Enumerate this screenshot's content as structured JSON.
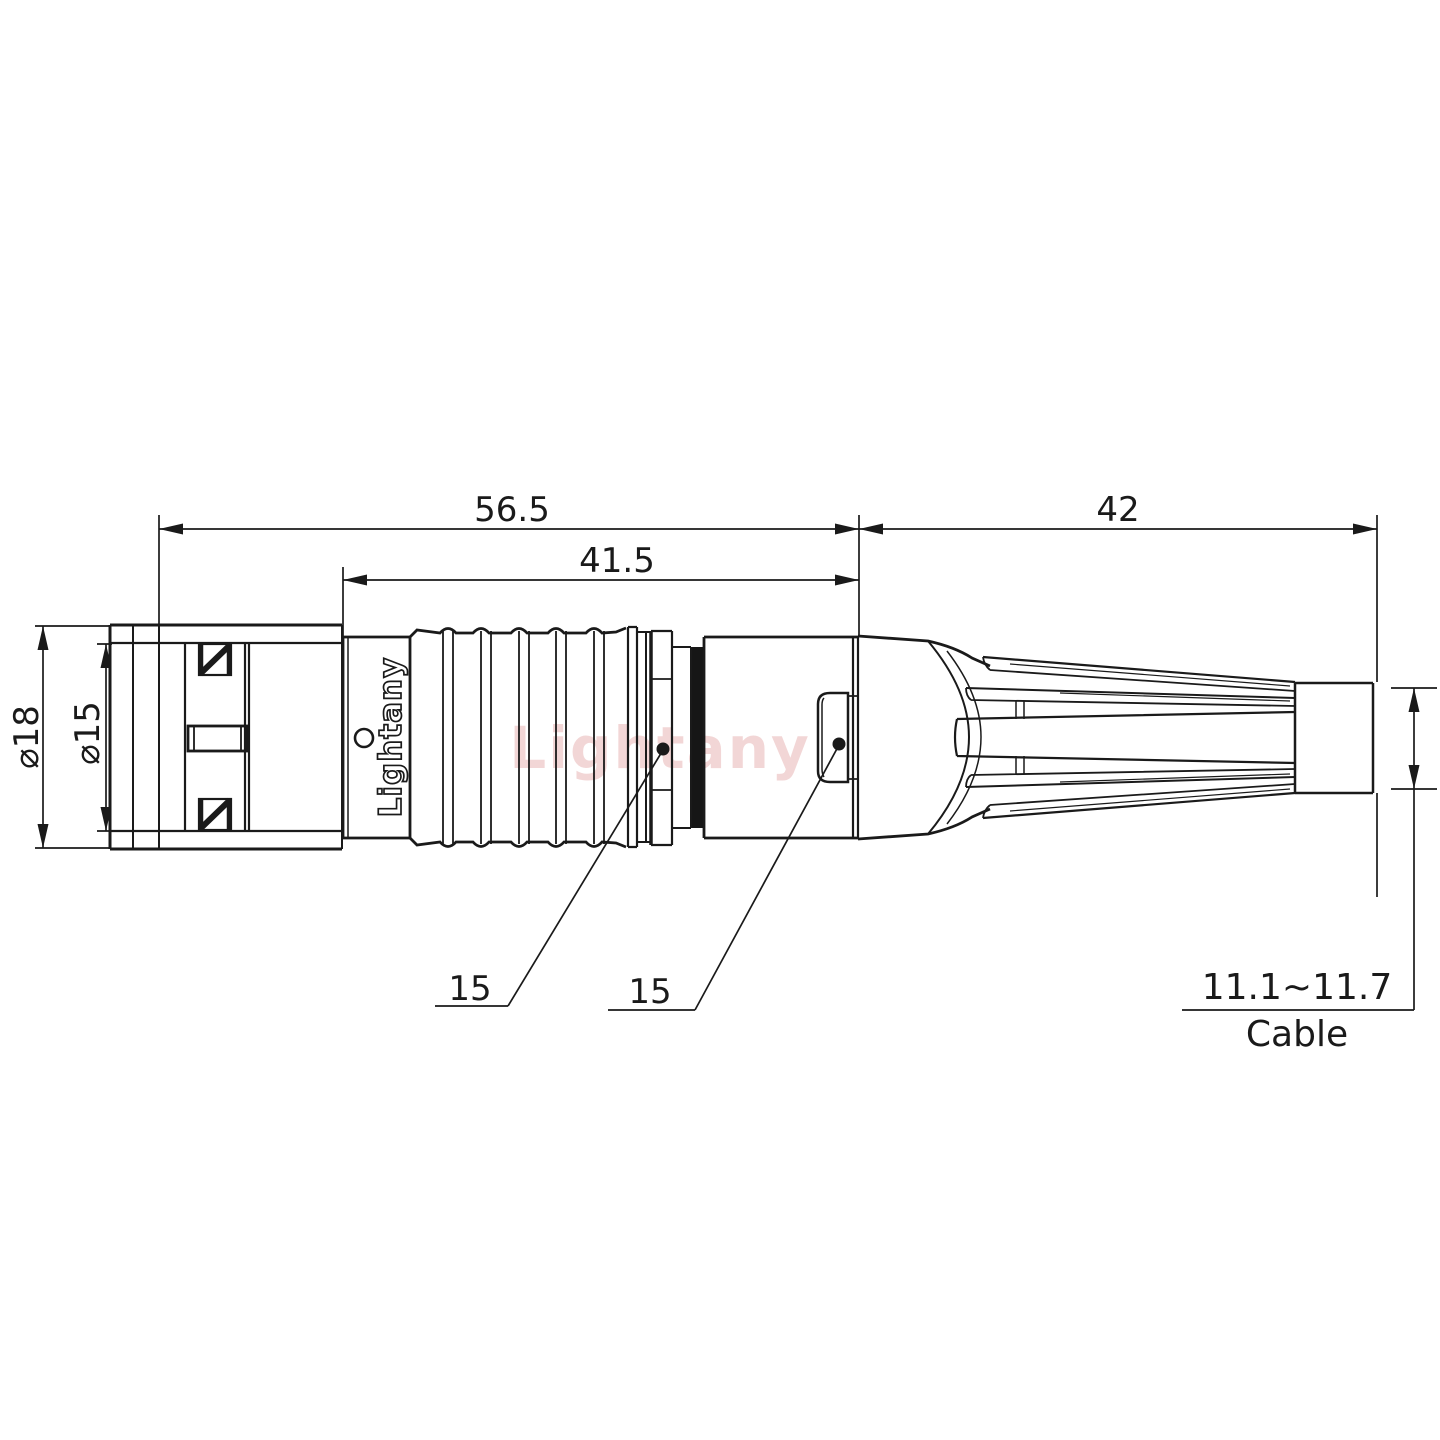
{
  "drawing": {
    "watermark": "Lightany",
    "part_marking": "Lightany",
    "dimensions": {
      "overall_length": "56.5",
      "front_body_length": "41.5",
      "boot_length": "42",
      "outer_diameter": "⌀18",
      "inner_diameter": "⌀15",
      "collar_callout": "15",
      "housing_callout": "15",
      "cable_diameter_range": "11.1~11.7",
      "cable_label": "Cable"
    },
    "colors": {
      "line": "#1a1a1a",
      "watermark": "#e9b5b5",
      "seal_fill": "#161616"
    }
  }
}
